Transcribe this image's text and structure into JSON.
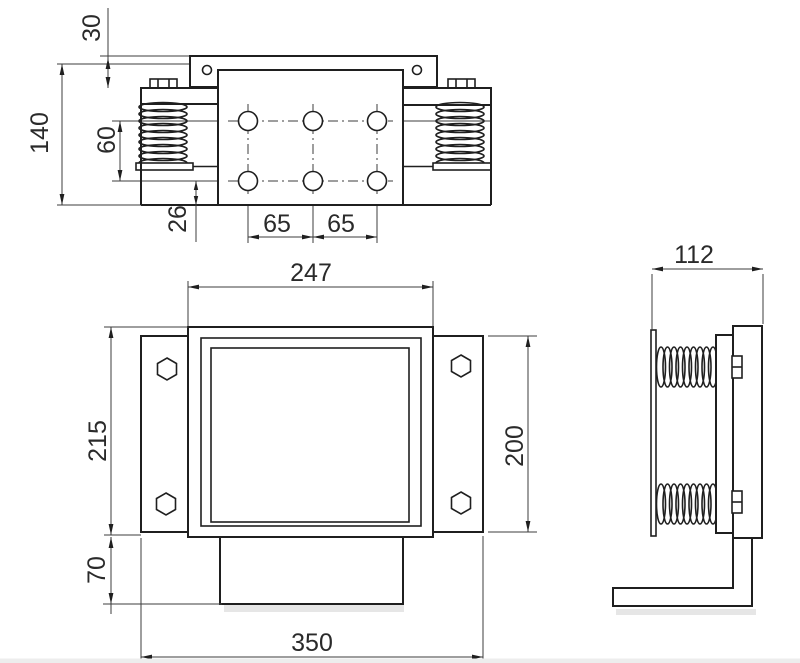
{
  "drawing": {
    "dims": {
      "v30": "30",
      "v140": "140",
      "v60": "60",
      "v26": "26",
      "v65_1": "65",
      "v65_2": "65",
      "v247": "247",
      "v215": "215",
      "v70": "70",
      "v350": "350",
      "v200": "200",
      "v112": "112"
    },
    "colors": {
      "line": "#1f1f1f",
      "thin_line": "#3d3d3d",
      "background": "#ffffff",
      "shadow": "#e6e6e6"
    }
  }
}
